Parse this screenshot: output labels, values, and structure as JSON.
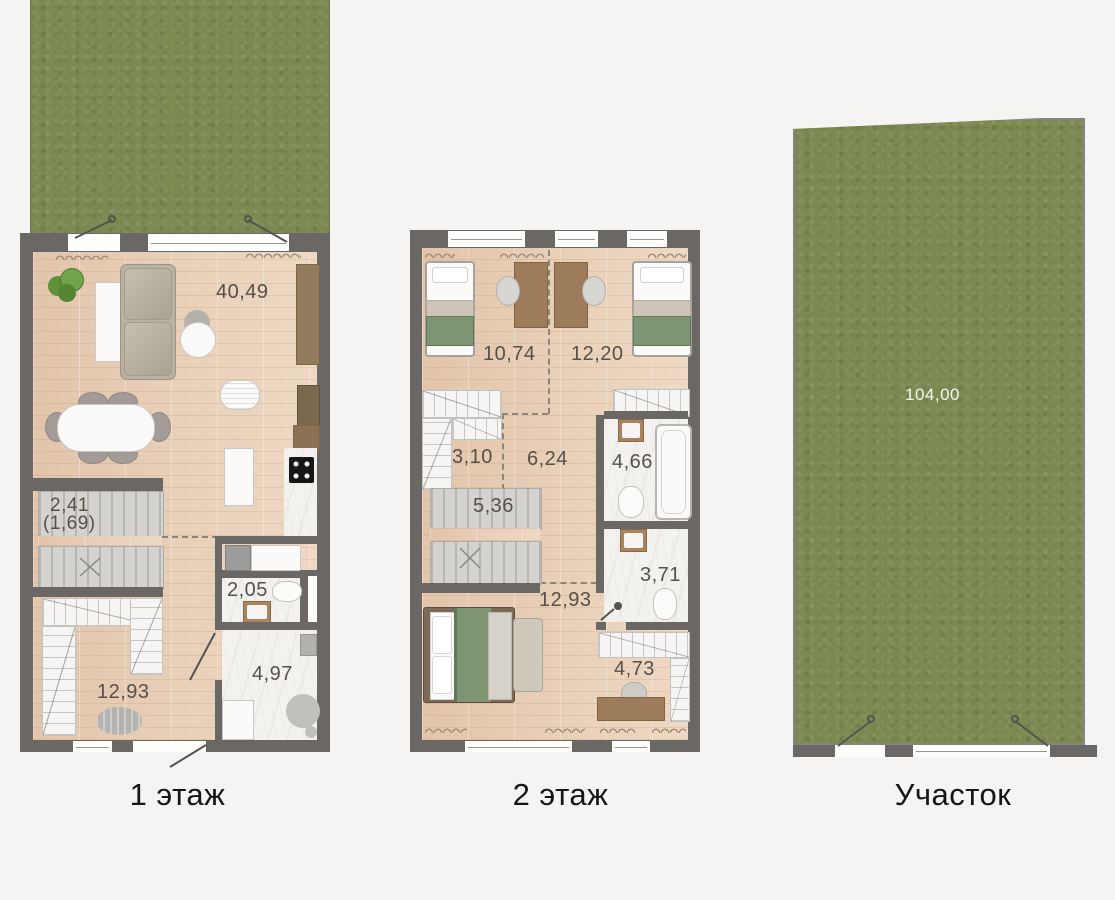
{
  "floor1": {
    "caption": "1 этаж",
    "living_area": "40,49",
    "stairs_area": "2,41",
    "stairs_area_alt": "(1,69)",
    "wc_area": "2,05",
    "bath_area": "4,97",
    "hall_area": "12,93"
  },
  "floor2": {
    "caption": "2 этаж",
    "bedroom_left_area": "10,74",
    "bedroom_right_area": "12,20",
    "wardrobe_area": "3,10",
    "hall_area": "6,24",
    "bath_top_area": "4,66",
    "stairs_area": "5,36",
    "bath_bottom_area": "3,71",
    "bedroom_master_area": "12,93",
    "cabinet_area": "4,73"
  },
  "plot": {
    "caption": "Участок",
    "area": "104,00"
  },
  "colors": {
    "wall": "#6a6765",
    "wood_floor": "#e6cdb6",
    "grass": "#7c8a52",
    "background": "#f5f4f2",
    "room_label": "#575049",
    "green_textile": "#7f9473"
  }
}
